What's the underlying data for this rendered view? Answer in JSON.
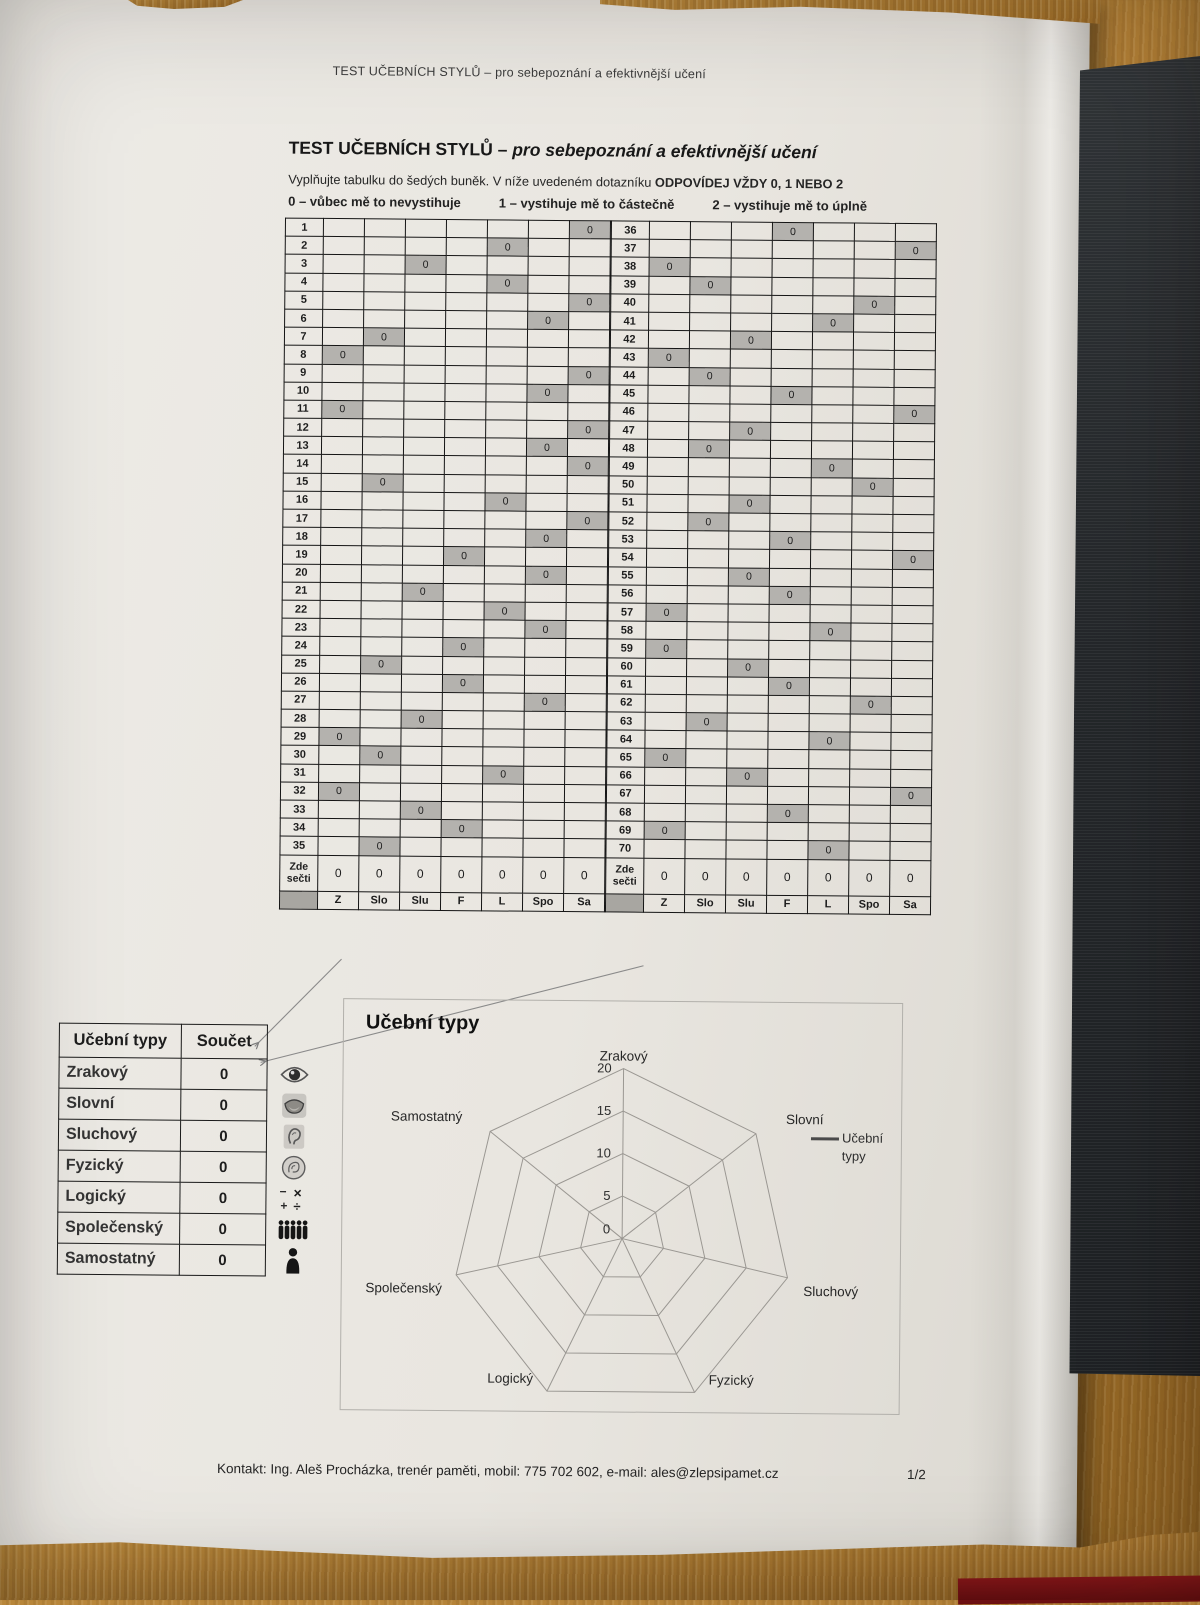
{
  "colors": {
    "paper": "#e9e6e0",
    "wood": "#a9762f",
    "dark_panel": "#24272a",
    "red_strip": "#7c1416",
    "cell_shade": "#b4b2ae"
  },
  "header": {
    "running_title": "TEST UČEBNÍCH STYLŮ – pro sebepoznání a efektivnější učení",
    "title_main": "TEST UČEBNÍCH STYLŮ – ",
    "title_italic": "pro sebepoznání a efektivnější učení",
    "instruction_plain": "Vyplňujte tabulku do šedých buněk. V níže uvedeném dotazníku ",
    "instruction_bold": "ODPOVÍDEJ VŽDY 0, 1 NEBO 2",
    "scale_options": [
      "0 – vůbec mě to nevystihuje",
      "1 – vystihuje mě to částečně",
      "2 – vystihuje mě to úplně"
    ]
  },
  "questionnaire": {
    "columns": [
      "Z",
      "Slo",
      "Slu",
      "F",
      "L",
      "Spo",
      "Sa"
    ],
    "sum_row_label": "Zde sečti",
    "filled_value": "0",
    "left_rows": [
      {
        "num": "1",
        "marked": "Sa"
      },
      {
        "num": "2",
        "marked": "L"
      },
      {
        "num": "3",
        "marked": "Slu"
      },
      {
        "num": "4",
        "marked": "L"
      },
      {
        "num": "5",
        "marked": "Sa"
      },
      {
        "num": "6",
        "marked": "Spo"
      },
      {
        "num": "7",
        "marked": "Slo"
      },
      {
        "num": "8",
        "marked": "Z"
      },
      {
        "num": "9",
        "marked": "Sa"
      },
      {
        "num": "10",
        "marked": "Spo"
      },
      {
        "num": "11",
        "marked": "Z"
      },
      {
        "num": "12",
        "marked": "Sa"
      },
      {
        "num": "13",
        "marked": "Spo"
      },
      {
        "num": "14",
        "marked": "Sa"
      },
      {
        "num": "15",
        "marked": "Slo"
      },
      {
        "num": "16",
        "marked": "L"
      },
      {
        "num": "17",
        "marked": "Sa"
      },
      {
        "num": "18",
        "marked": "Spo"
      },
      {
        "num": "19",
        "marked": "F"
      },
      {
        "num": "20",
        "marked": "Spo"
      },
      {
        "num": "21",
        "marked": "Slu"
      },
      {
        "num": "22",
        "marked": "L"
      },
      {
        "num": "23",
        "marked": "Spo"
      },
      {
        "num": "24",
        "marked": "F"
      },
      {
        "num": "25",
        "marked": "Slo"
      },
      {
        "num": "26",
        "marked": "F"
      },
      {
        "num": "27",
        "marked": "Spo"
      },
      {
        "num": "28",
        "marked": "Slu"
      },
      {
        "num": "29",
        "marked": "Z"
      },
      {
        "num": "30",
        "marked": "Slo"
      },
      {
        "num": "31",
        "marked": "L"
      },
      {
        "num": "32",
        "marked": "Z"
      },
      {
        "num": "33",
        "marked": "Slu"
      },
      {
        "num": "34",
        "marked": "F"
      },
      {
        "num": "35",
        "marked": "Slo"
      }
    ],
    "right_rows": [
      {
        "num": "36",
        "marked": "F"
      },
      {
        "num": "37",
        "marked": "Sa"
      },
      {
        "num": "38",
        "marked": "Z"
      },
      {
        "num": "39",
        "marked": "Slo"
      },
      {
        "num": "40",
        "marked": "Spo"
      },
      {
        "num": "41",
        "marked": "L"
      },
      {
        "num": "42",
        "marked": "Slu"
      },
      {
        "num": "43",
        "marked": "Z"
      },
      {
        "num": "44",
        "marked": "Slo"
      },
      {
        "num": "45",
        "marked": "F"
      },
      {
        "num": "46",
        "marked": "Sa"
      },
      {
        "num": "47",
        "marked": "Slu"
      },
      {
        "num": "48",
        "marked": "Slo"
      },
      {
        "num": "49",
        "marked": "L"
      },
      {
        "num": "50",
        "marked": "Spo"
      },
      {
        "num": "51",
        "marked": "Slu"
      },
      {
        "num": "52",
        "marked": "Slo"
      },
      {
        "num": "53",
        "marked": "F"
      },
      {
        "num": "54",
        "marked": "Sa"
      },
      {
        "num": "55",
        "marked": "Slu"
      },
      {
        "num": "56",
        "marked": "F"
      },
      {
        "num": "57",
        "marked": "Z"
      },
      {
        "num": "58",
        "marked": "L"
      },
      {
        "num": "59",
        "marked": "Z"
      },
      {
        "num": "60",
        "marked": "Slu"
      },
      {
        "num": "61",
        "marked": "F"
      },
      {
        "num": "62",
        "marked": "Spo"
      },
      {
        "num": "63",
        "marked": "Slo"
      },
      {
        "num": "64",
        "marked": "L"
      },
      {
        "num": "65",
        "marked": "Z"
      },
      {
        "num": "66",
        "marked": "Slu"
      },
      {
        "num": "67",
        "marked": "Sa"
      },
      {
        "num": "68",
        "marked": "F"
      },
      {
        "num": "69",
        "marked": "Z"
      },
      {
        "num": "70",
        "marked": "L"
      }
    ],
    "left_sums": [
      "0",
      "0",
      "0",
      "0",
      "0",
      "0",
      "0"
    ],
    "right_sums": [
      "0",
      "0",
      "0",
      "0",
      "0",
      "0",
      "0"
    ]
  },
  "summary_table": {
    "headers": [
      "Učební typy",
      "Součet"
    ],
    "rows": [
      {
        "label": "Zrakový",
        "value": "0",
        "icon": "eye-icon"
      },
      {
        "label": "Slovní",
        "value": "0",
        "icon": "mouth-icon"
      },
      {
        "label": "Sluchový",
        "value": "0",
        "icon": "ear-icon"
      },
      {
        "label": "Fyzický",
        "value": "0",
        "icon": "touch-icon"
      },
      {
        "label": "Logický",
        "value": "0",
        "icon": "math-icon"
      },
      {
        "label": "Společenský",
        "value": "0",
        "icon": "people-icon"
      },
      {
        "label": "Samostatný",
        "value": "0",
        "icon": "person-icon"
      }
    ]
  },
  "chart_data": {
    "type": "radar",
    "title": "Učební typy",
    "categories": [
      "Zrakový",
      "Slovní",
      "Sluchový",
      "Fyzický",
      "Logický",
      "Společenský",
      "Samostatný"
    ],
    "series": [
      {
        "name": "Učební typy",
        "values": [
          0,
          0,
          0,
          0,
          0,
          0,
          0
        ]
      }
    ],
    "ticks": [
      0,
      5,
      10,
      15,
      20
    ],
    "max": 20,
    "grid": true,
    "legend_position": "right",
    "legend_label": "Učební typy"
  },
  "footer": {
    "contact": "Kontakt: Ing. Aleš Procházka, trenér paměti, mobil: 775 702 602, e-mail: ales@zlepsipamet.cz",
    "page_number": "1/2"
  }
}
